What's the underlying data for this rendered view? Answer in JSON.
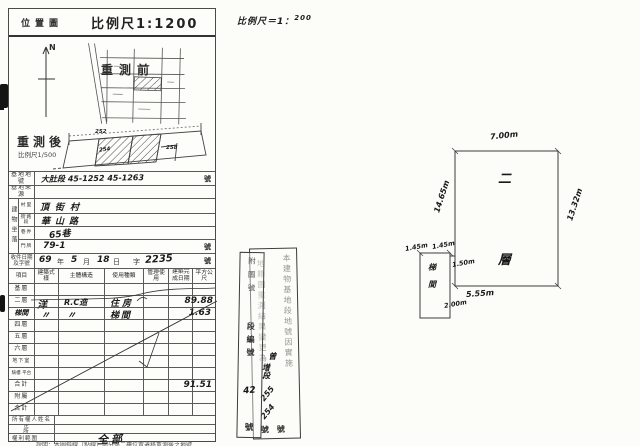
{
  "header": {
    "title": "位置圖",
    "scale": "比例尺1:1200"
  },
  "scale_note": {
    "prefix": "比例尺＝1：",
    "value": "200"
  },
  "map": {
    "north": "N",
    "before_label": "重測前",
    "after_label": "重測後",
    "after_scale": "比例尺1/500",
    "num_top": "252",
    "num_left": "254",
    "num_right": "258"
  },
  "site": {
    "lot_label": "基地地號",
    "lot_value": "大肚段 45-1252 45-1263",
    "lot_suffix": "號",
    "source_label": "基地來源",
    "loc_label": "建物坐落",
    "village_label": "村里",
    "village_value": "頂街村",
    "street_label": "街路段",
    "street_value": "華山路",
    "lane_label": "巷弄",
    "lane_value": "65巷",
    "door_label": "門牌",
    "door_value": "79-1",
    "door_suffix": "號",
    "receipt_label_1": "收件日期",
    "receipt_label_2": "及字號",
    "receipt": {
      "year": "69",
      "y": "年",
      "month": "5",
      "m": "月",
      "day": "18",
      "d": "日",
      "zi": "字",
      "no": "2235",
      "hao": "號"
    }
  },
  "grid": {
    "headers": [
      "項目",
      "建築式樣",
      "主體構造",
      "使用種類",
      "管理使用",
      "建築完成日期",
      "平方公尺"
    ],
    "rows": [
      {
        "label": "基層",
        "c1": "",
        "c2": "",
        "c3": "",
        "area": ""
      },
      {
        "label": "二層",
        "c1": "洋",
        "c2": "R.C造",
        "c3": "住房",
        "area": "89.88"
      },
      {
        "label": "梯間",
        "c1": "〃",
        "c2": "〃",
        "c3": "梯間",
        "area": "1.63"
      },
      {
        "label": "四層",
        "c1": "",
        "c2": "",
        "c3": "",
        "area": ""
      },
      {
        "label": "五層",
        "c1": "",
        "c2": "",
        "c3": "",
        "area": ""
      },
      {
        "label": "六層",
        "c1": "",
        "c2": "",
        "c3": "",
        "area": ""
      },
      {
        "label": "地下室",
        "c1": "",
        "c2": "",
        "c3": "",
        "area": ""
      },
      {
        "label": "騎樓 平台",
        "c1": "",
        "c2": "",
        "c3": "",
        "area": ""
      },
      {
        "label": "合計",
        "c1": "",
        "c2": "",
        "c3": "",
        "area": "91.51"
      },
      {
        "label": "附屬",
        "c1": "",
        "c2": "",
        "c3": "",
        "area": ""
      },
      {
        "label": "合計",
        "c1": "",
        "c2": "",
        "c3": "",
        "area": ""
      }
    ]
  },
  "owner": {
    "name_label": "所有權人姓名",
    "addr_label": "住　所",
    "rights_label": "權利範圍",
    "rights_value": "全部"
  },
  "footnote": "說明：本圖斜線（點線）部分係二樓位置遷移重測後之地號……",
  "plan": {
    "room_char1": "二",
    "room_char2": "層",
    "stair_char1": "梯",
    "stair_char2": "間",
    "dim_top": "7.00m",
    "dim_left": "14.65m",
    "dim_right": "13.32m",
    "dim_bottom": "5.55m",
    "dim_stair_top1": "1.45m",
    "dim_stair_top2": "1.45m",
    "dim_stair_right": "1.50m",
    "dim_stair_bottom": "2.00m"
  },
  "stamps": {
    "attach": {
      "printed": "附圖號",
      "printed2": "段編號",
      "hand": "42",
      "suffix": "號"
    },
    "note": {
      "col_right": "本建物基地段地號因實施",
      "col_left": "地籍圖重測結果變更為",
      "hand_a": "曾",
      "hand_b": "增段",
      "hand_c": "255",
      "hand_d": "254",
      "suffix": "號號"
    }
  }
}
